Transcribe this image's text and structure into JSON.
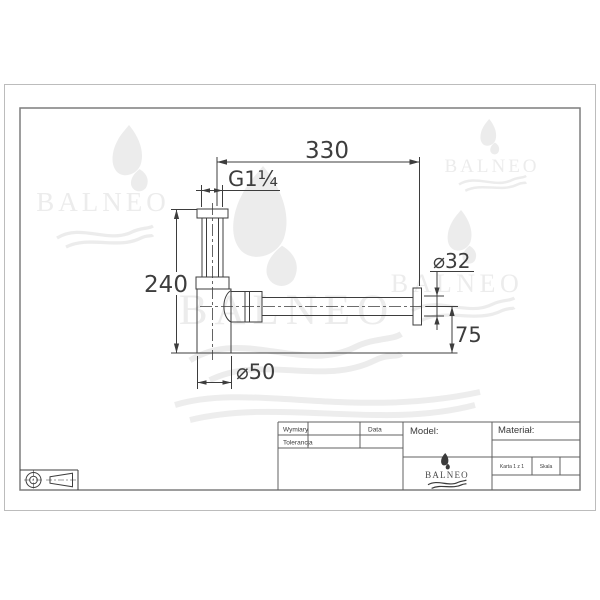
{
  "drawing": {
    "dimensions": {
      "total_width": "330",
      "thread_size": "G1¼",
      "total_height": "240",
      "outlet_diameter": "⌀32",
      "outlet_center_height": "75",
      "body_diameter": "⌀50"
    }
  },
  "title_block": {
    "dimensions_label": "Wymiary",
    "tolerance_label": "Tolerancja",
    "date_label": "Data",
    "model_label": "Model:",
    "material_label": "Materiał:",
    "sheet_label": "Karta 1 z 1",
    "scale_label": "Skala",
    "brand": "BALNEO"
  },
  "watermark": {
    "brand": "BALNEO"
  }
}
